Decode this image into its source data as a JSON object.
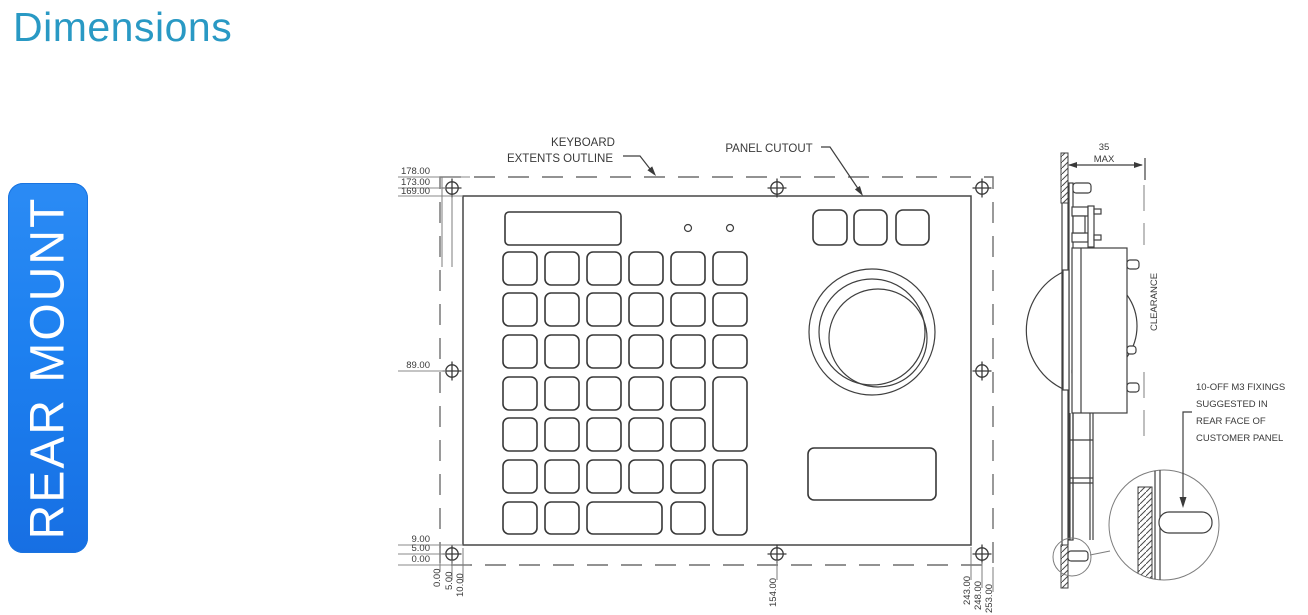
{
  "title": "Dimensions",
  "badge": {
    "label": "REAR MOUNT",
    "color": "#1d80f0"
  },
  "front": {
    "callouts": {
      "keyboard_extents_line1": "KEYBOARD",
      "keyboard_extents_line2": "EXTENTS OUTLINE",
      "panel_cutout": "PANEL CUTOUT"
    },
    "dims_left": {
      "outline_top": "178.00",
      "holes_top": "173.00",
      "cutout_top": "169.00",
      "holes_middle": "89.00",
      "cutout_bottom": "9.00",
      "holes_bottom": "5.00",
      "outline_bottom": "0.00"
    },
    "dims_bottom": {
      "outline_left": "0.00",
      "holes_left": "5.00",
      "cutout_left": "10.00",
      "holes_middle": "154.00",
      "cutout_right": "243.00",
      "holes_right": "248.00",
      "outline_right": "253.00"
    }
  },
  "side": {
    "depth_dim": {
      "value": "35",
      "qualifier": "MAX"
    },
    "clearance_label": "CLEARANCE",
    "fixings_note": {
      "line1": "10-OFF M3 FIXINGS",
      "line2": "SUGGESTED IN",
      "line3": "REAR FACE OF",
      "line4": "CUSTOMER PANEL"
    }
  },
  "colors": {
    "title_text": "#2999c4",
    "badge_background": "#1d80f0",
    "badge_text": "#ffffff",
    "drawing_line": "#3f3f3f",
    "dimension_line": "#8a8a8a"
  }
}
